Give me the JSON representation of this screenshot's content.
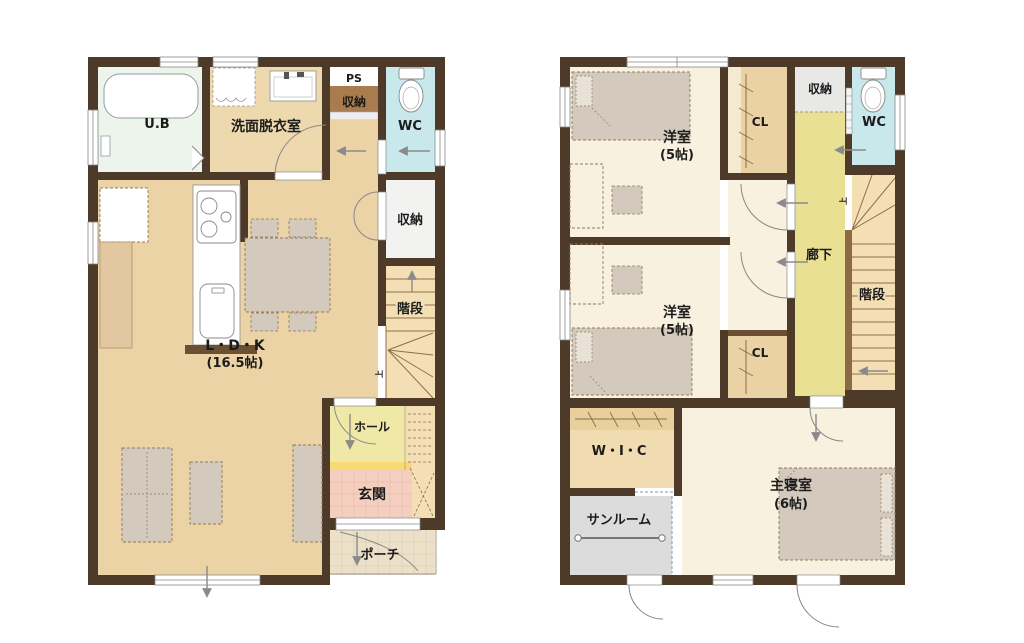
{
  "diagram_type": "japanese_house_floor_plan",
  "floor1": {
    "rooms": {
      "ub": "U.B",
      "washroom": "洗面脱衣室",
      "ps": "PS",
      "storage_upper": "収納",
      "wc": "WC",
      "storage_mid": "収納",
      "stairs": "階段",
      "ldk": "L・D・K",
      "ldk_size": "(16.5帖)",
      "hall": "ホール",
      "entrance": "玄関",
      "porch": "ポーチ",
      "stairs_up_mark": "上"
    }
  },
  "floor2": {
    "rooms": {
      "bedroom1": "洋室",
      "bedroom1_size": "(5帖)",
      "closet1": "CL",
      "storage": "収納",
      "wc": "WC",
      "corridor": "廊下",
      "stairs": "階段",
      "bedroom2": "洋室",
      "bedroom2_size": "(5帖)",
      "closet2": "CL",
      "wic": "W・I・C",
      "sunroom": "サンルーム",
      "master_bedroom": "主寝室",
      "master_bedroom_size": "(6帖)",
      "stairs_up_mark": "上"
    }
  },
  "colors": {
    "wall": "#4e3a29",
    "floor_tan": "#ecd3a6",
    "washroom_tan": "#eed8ae",
    "floor_cream": "#f8f1e0",
    "bath_green": "#edf4ec",
    "wc_blue": "#c8e8ec",
    "storage_white": "#f2f2f0",
    "storage_gray": "#e8e8e6",
    "storage_brown": "#a87c4e",
    "stairs_tan": "#f4dfb5",
    "hall_yellow": "#f0e8a6",
    "corridor_yellow": "#e9e093",
    "entrance_pink": "#f4cfc0",
    "step_yellow": "#f9d876",
    "porch_beige": "#ece0c9",
    "closet_tan": "#ead2a4",
    "wic_tan": "#f1dcb1",
    "sunroom_gray": "#dcdcdc",
    "furniture_gray": "#d3c9bc",
    "counter_brown": "#6b4f33",
    "arrow_gray": "#8a8a8a"
  }
}
